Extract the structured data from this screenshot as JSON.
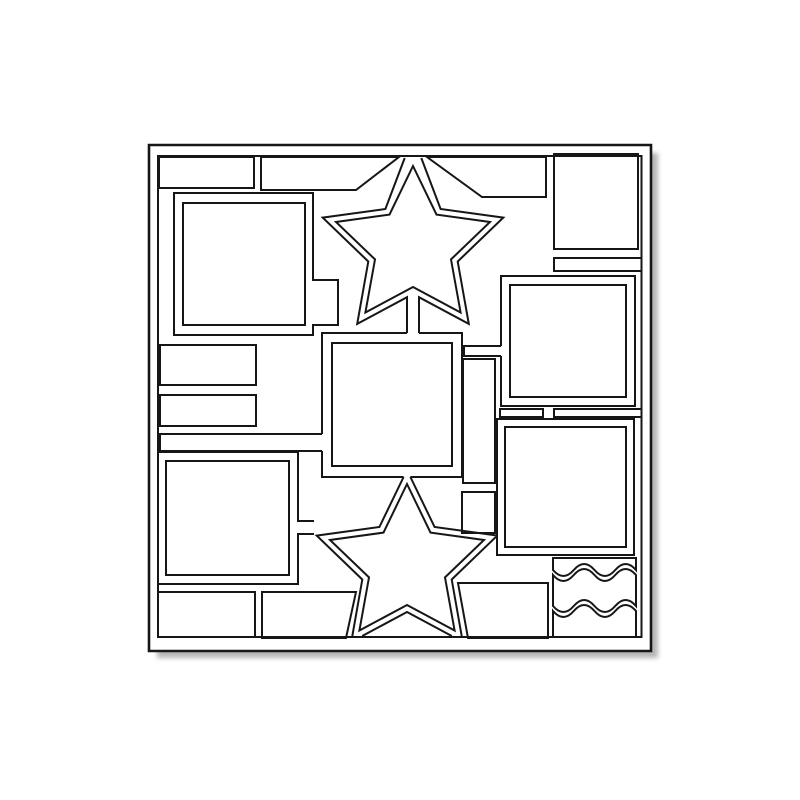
{
  "meta": {
    "description": "Die-cut scrapbook page template line drawing",
    "canvas": {
      "width": 800,
      "height": 800
    }
  },
  "drawing": {
    "background_color": "#ffffff",
    "line_color": "#161616",
    "shadow_color": "#b5b5b5",
    "stroke_width": 2,
    "border_stroke_width": 2.6,
    "shapes": [
      {
        "name": "page-drop-shadow",
        "d": "M157,153 H658 V658 H157 Z",
        "fill": "#b5b5b5",
        "stroke": "none",
        "blur": true
      },
      {
        "name": "page-outer-border",
        "d": "M149,145 H651 V651 H149 Z",
        "fill": "#ffffff",
        "sw": 2.6
      },
      {
        "name": "page-inner-border-line",
        "d": "M158,156 H641.5 V637 H158 Z"
      },
      {
        "name": "top-left-small-rect",
        "d": "M159,157 H254 V188 H159 Z"
      },
      {
        "name": "top-band-left",
        "d": "M261,157 L399,157 L356,190 L261,190 Z"
      },
      {
        "name": "top-band-right",
        "d": "M427,157 L546,157 L546,197 L482,197 Z"
      },
      {
        "name": "top-right-rect",
        "d": "M554,154 H638 V249 H554 Z"
      },
      {
        "name": "top-left-square-frame-outer",
        "d": "M174,193 L313,193 L313,280 L338,280 L338,325 L313,325 L313,335 L174,335 Z"
      },
      {
        "name": "top-left-square-frame-window",
        "d": "M183,203 H305 V325 H183 Z"
      },
      {
        "name": "top-star-frame-outer",
        "d": "M421.3,158 L440.6,209 L503.3,217.6 L457.7,261.5 L468.8,323.9 L419,297.2 L419,333 M407,333 L407,297.2 L357.2,323.9 L368.3,261.5 L322.7,217.6 L385.4,209 L404.7,158"
      },
      {
        "name": "top-star-frame-window",
        "d": "M413,166 L436.5,214.6 L490,222 L451,259.4 L460.6,312.5 L413,287 L365.4,312.5 L375,259.4 L336,222 L389.5,214.6 Z"
      },
      {
        "name": "left-strip-upper",
        "d": "M160,345 H256 V385 H160 Z"
      },
      {
        "name": "left-strip-lower",
        "d": "M160,395 H256 V426 H160 Z"
      },
      {
        "name": "left-long-thin-strip",
        "d": "M322,434 H160 V451 H322"
      },
      {
        "name": "center-square-frame-outer",
        "d": "M419,333 H462 V477 H410.4 M403.6,477 H322 V451 M322,434 V333 H407"
      },
      {
        "name": "center-square-frame-window",
        "d": "M332,343 H452 V466 H332 Z"
      },
      {
        "name": "right-strip-top",
        "d": "M641,258 H554 V271 H641"
      },
      {
        "name": "mid-right-square-frame-outer",
        "d": "M501,346 V276 H635 V406 H501 V356"
      },
      {
        "name": "mid-right-square-frame-window",
        "d": "M510,285 H626 V397 H510 Z"
      },
      {
        "name": "mid-right-connector-tab",
        "d": "M501,346 L464,346 L464,356 L501,356"
      },
      {
        "name": "center-right-tall-rect",
        "d": "M463,359 H495 V483 H463 Z"
      },
      {
        "name": "mid-right-strip-left",
        "d": "M500,409 H543 V417 H500 Z"
      },
      {
        "name": "mid-right-strip-right",
        "d": "M641,409 H554 V417 H641"
      },
      {
        "name": "bottom-right-square-frame-outer",
        "d": "M497,419 H634 V555 H497 Z"
      },
      {
        "name": "bottom-right-square-frame-window",
        "d": "M505,427 H626 V547 H505 Z"
      },
      {
        "name": "center-small-rect",
        "d": "M462,492 H495 V533 H462 Z"
      },
      {
        "name": "bottom-star-frame-outer",
        "d": "M410.4,477 L434.6,527 L496,535.4 M496,536.8 L451.7,579.5 L461.7,636 M451.8,636 L407,612 L362.2,636 M352.3,636 L362.3,579.5 L316.7,535.6 L379.4,527 L403.6,477"
      },
      {
        "name": "bottom-star-frame-window",
        "d": "M407,484 L430.5,532.6 L484,540 L445,577.4 L454.6,630.5 L407,605 L359.4,630.5 L369,577.4 L330,540 L383.5,532.6 Z"
      },
      {
        "name": "bottom-left-square-frame-outer",
        "d": "M314,521 L298,521 L298,452 L158,452 L158,584 L298,584 L298,534 L314,534"
      },
      {
        "name": "bottom-left-square-frame-window",
        "d": "M166,461 H289 V575 H166 Z"
      },
      {
        "name": "bottom-left-strip",
        "d": "M158,592 H255 V637 H158 Z"
      },
      {
        "name": "bottom-middle-left-piece",
        "d": "M262,592 L356,592 L346,638 L262,638 Z"
      },
      {
        "name": "bottom-middle-right-piece",
        "d": "M458,583 L548,583 L548,638 L468,638 Z"
      },
      {
        "name": "wave-band-top",
        "d": "M553,558 L636,558 L636,570 c-6.9,-8 -13.8,-8 -20.75,0 c-6.9,8 -13.8,8 -20.75,0 c-6.9,-8 -13.8,-8 -20.75,0 c-6.9,8 -13.8,8 -20.75,0 Z"
      },
      {
        "name": "wave-band-middle",
        "d": "M553,575 c6.9,8 13.8,8 20.75,0 c6.9,-8 13.8,-8 20.75,0 c6.9,8 13.8,8 20.75,0 c6.9,-8 13.8,-8 20.75,0 L636,606 c-6.9,-8 -13.8,-8 -20.75,0 c-6.9,8 -13.8,8 -20.75,0 c-6.9,-8 -13.8,-8 -20.75,0 c-6.9,8 -13.8,8 -20.75,0 Z"
      },
      {
        "name": "wave-band-bottom",
        "d": "M553,611 c6.9,8 13.8,8 20.75,0 c6.9,-8 13.8,-8 20.75,0 c6.9,8 13.8,8 20.75,0 c6.9,-8 13.8,-8 20.75,0 L636,637 L553,637 Z"
      }
    ]
  }
}
